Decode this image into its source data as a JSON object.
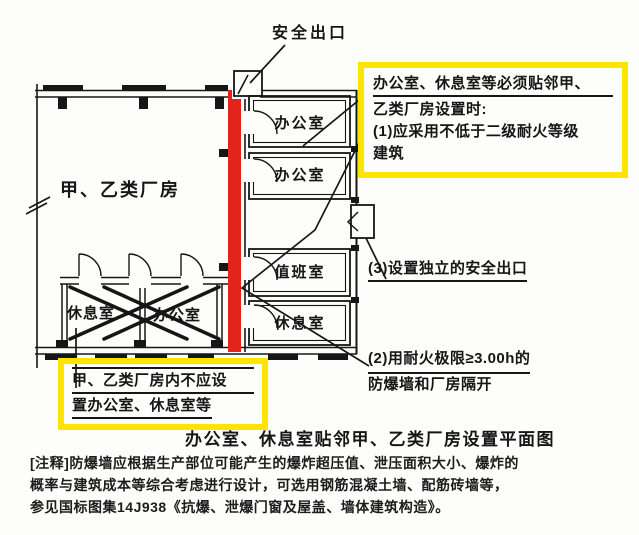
{
  "colors": {
    "highlight_yellow": "#FFE400",
    "explosion_wall_red": "#E3241B",
    "ink": "#161616"
  },
  "plan": {
    "safety_exit_label": "安全出口",
    "factory_label": "甲、乙类厂房",
    "annex_rooms": [
      "办公室",
      "办公室",
      "值班室",
      "休息室"
    ],
    "crossed_rooms": [
      "休息室",
      "办公室"
    ]
  },
  "callouts": {
    "requirement": {
      "line1": "办公室、休息室等必须贴邻甲、",
      "line2": "乙类厂房设置时:",
      "line3": "(1)应采用不低于二级耐火等级",
      "line4": "建筑"
    },
    "prohibition": {
      "line1": "甲、乙类厂房内不应设",
      "line2": "置办公室、休息室等"
    },
    "independent_exit": "(3)设置独立的安全出口",
    "firewall": {
      "line1": "(2)用耐火极限≥3.00h的",
      "line2": "防爆墙和厂房隔开"
    }
  },
  "caption": "办公室、休息室贴邻甲、乙类厂房设置平面图",
  "notes": {
    "line1": "[注释]防爆墙应根据生产部位可能产生的爆炸超压值、泄压面积大小、爆炸的",
    "line2": "概率与建筑成本等综合考虑进行设计，可选用钢筋混凝土墙、配筋砖墙等，",
    "line3": "参见国标图集14J938《抗爆、泄爆门窗及屋盖、墙体建筑构造》。"
  }
}
